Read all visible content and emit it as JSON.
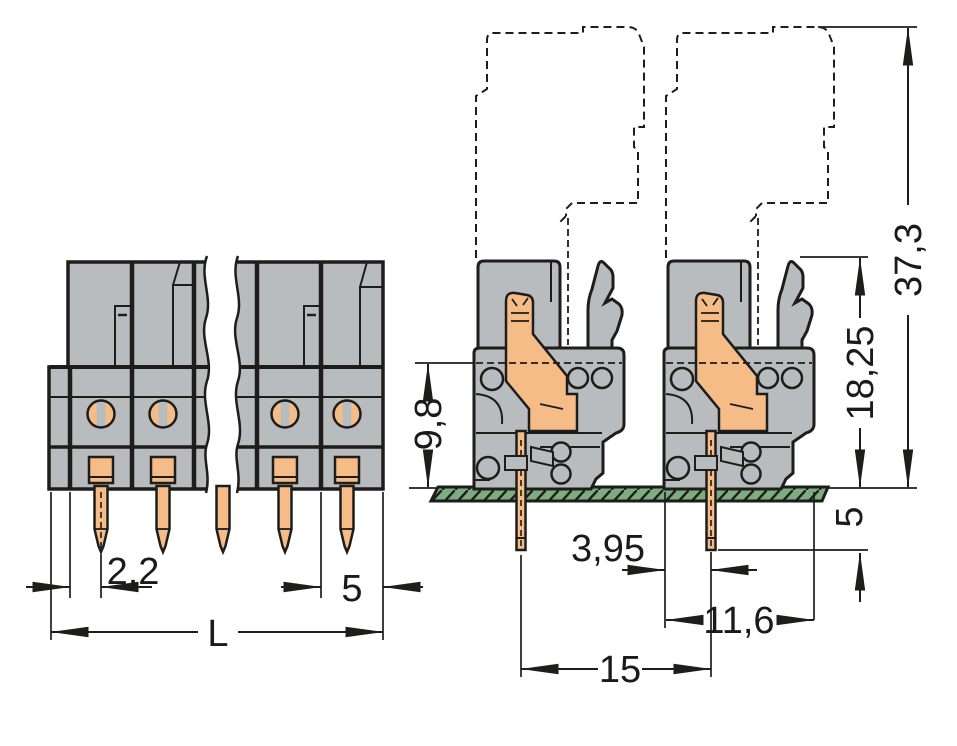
{
  "drawing_type": "connector-dimensional-drawing",
  "colors": {
    "housing_gray": "#b9bcbe",
    "contact_orange": "#f6bc88",
    "pcb_green": "#7dac80",
    "line_black": "#1d1d1b",
    "background": "#ffffff"
  },
  "dimensions": {
    "front_view": {
      "pin_offset": "2,2",
      "pole_pitch": "5",
      "total_length": "L"
    },
    "side_view": {
      "height_above_board": "9,8",
      "height_with_latch": "18,25",
      "total_height_with_plug": "37,3",
      "pin_length_below_board": "5",
      "pin_offset_from_edge": "3,95",
      "housing_depth": "11,6",
      "pin_spacing": "15"
    }
  }
}
